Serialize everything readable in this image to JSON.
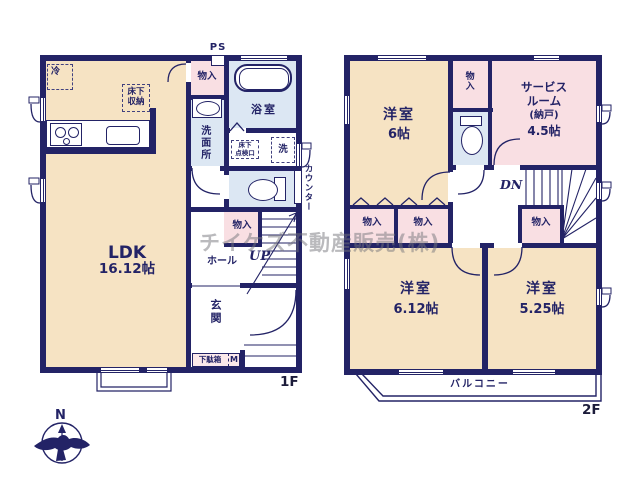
{
  "watermark": "チイケズ不動産販売(株)",
  "compass": {
    "north_label": "N"
  },
  "colors": {
    "wall_navy": "#232366",
    "room_beige": "#f6e3c3",
    "room_pink": "#f9dfe3",
    "room_blue": "#dce7f3",
    "shoe_strip_pink": "#fbe9ea",
    "watermark_gray": "#76767c"
  },
  "floor1": {
    "floor_label": "1F",
    "ldk": {
      "name": "LDK",
      "size": "16.12帖"
    },
    "entrance": "玄関",
    "hall": "ホール",
    "stairs_up": "UP",
    "washroom": "洗面所",
    "bathroom": "浴室",
    "closet_top": "物入",
    "closet_hall": "物入",
    "pipe_space": "PS",
    "counter": "カウンター",
    "refrigerator": "冷",
    "floor_storage": {
      "line1": "床下",
      "line2": "収納"
    },
    "inspection_hatch": {
      "line1": "床下",
      "line2": "点検口"
    },
    "laundry": "洗",
    "shoe_box": "下駄箱",
    "meter": "M"
  },
  "floor2": {
    "floor_label": "2F",
    "bedroom1": {
      "name": "洋室",
      "size": "6帖"
    },
    "service_room": {
      "line1": "サービス",
      "line2": "ルーム",
      "line3": "(納戸)",
      "size": "4.5帖"
    },
    "bedroom2": {
      "name": "洋室",
      "size": "6.12帖"
    },
    "bedroom3": {
      "name": "洋室",
      "size": "5.25帖"
    },
    "closet_top": "物入",
    "closet_a": "物入",
    "closet_b": "物入",
    "closet_stairs": "物入",
    "stairs_down": "DN",
    "balcony": "バルコニー"
  }
}
